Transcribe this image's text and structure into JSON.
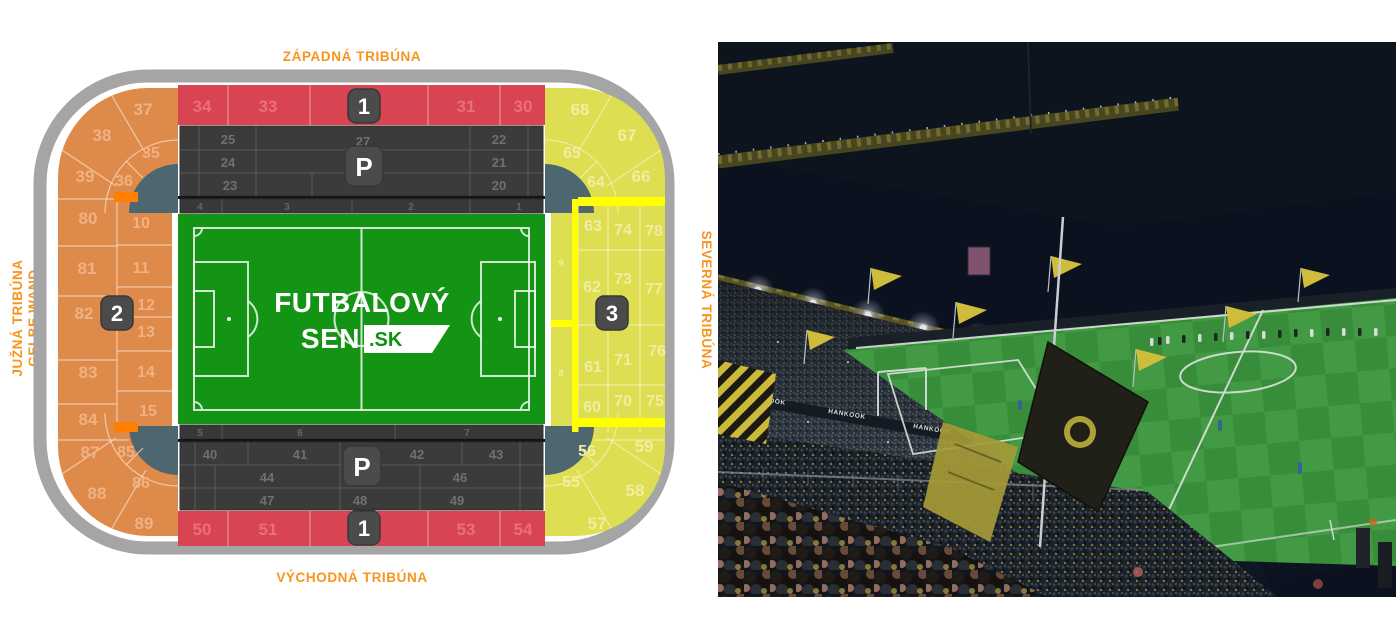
{
  "map": {
    "labels": {
      "west": "ZÁPADNÁ TRIBÚNA",
      "east": "VÝCHODNÁ TRIBÚNA",
      "south1": "JUŽNÁ TRIBÚNA",
      "south2": "GELBE WAND",
      "north": "SEVERNÁ TRIBÚNA"
    },
    "badges": {
      "west": "1",
      "east": "1",
      "south": "2",
      "north": "3",
      "park_top": "P",
      "park_bottom": "P"
    },
    "logo": {
      "line1": "FUTBALOVÝ",
      "line2": "SEN",
      "domain": ".SK"
    },
    "rows_top": {
      "c1": "4",
      "c2": "3",
      "c3": "2",
      "c4": "1"
    },
    "rows_bottom": {
      "c1": "5",
      "c2": "6",
      "c3": "7"
    },
    "sec": {
      "34": "34",
      "33": "33",
      "31": "31",
      "30": "30",
      "25": "25",
      "27": "27",
      "22": "22",
      "24": "24",
      "21": "21",
      "23": "23",
      "20": "20",
      "37": "37",
      "38": "38",
      "35": "35",
      "39": "39",
      "36": "36",
      "80": "80",
      "10": "10",
      "81": "81",
      "11": "11",
      "82": "82",
      "12": "12",
      "13": "13",
      "83": "83",
      "14": "14",
      "84": "84",
      "15": "15",
      "87": "87",
      "85": "85",
      "86": "86",
      "88": "88",
      "89": "89",
      "68": "68",
      "67": "67",
      "65": "65",
      "64": "64",
      "66": "66",
      "63": "63",
      "74": "74",
      "78": "78",
      "9": "9",
      "62": "62",
      "73": "73",
      "77": "77",
      "61": "61",
      "71": "71",
      "76": "76",
      "8": "8",
      "60": "60",
      "70": "70",
      "75": "75",
      "56": "56",
      "59": "59",
      "55": "55",
      "58": "58",
      "57": "57",
      "40": "40",
      "41": "41",
      "42": "42",
      "43": "43",
      "44": "44",
      "46": "46",
      "47": "47",
      "48": "48",
      "49": "49",
      "50": "50",
      "51": "51",
      "53": "53",
      "54": "54"
    },
    "colors": {
      "accent_orange": "#F7941E",
      "stand_red": "#D94452",
      "stand_orange": "#DD8A4A",
      "stand_yellow": "#DEDE52",
      "bright_yellow": "#FFFF00",
      "bright_orange": "#FF7F00",
      "pitch_green": "#149414",
      "block_dark": "#3B3B3B",
      "ring_gray": "#A5A5A5",
      "notch_slate": "#4D6670"
    }
  },
  "photo": {
    "roof_banner": "SIGNAL IDUNA PARK",
    "ads": {
      "hankook": "HANKOOK",
      "oknoplast": "OKNOPLAST",
      "rewe": "REWE"
    }
  }
}
